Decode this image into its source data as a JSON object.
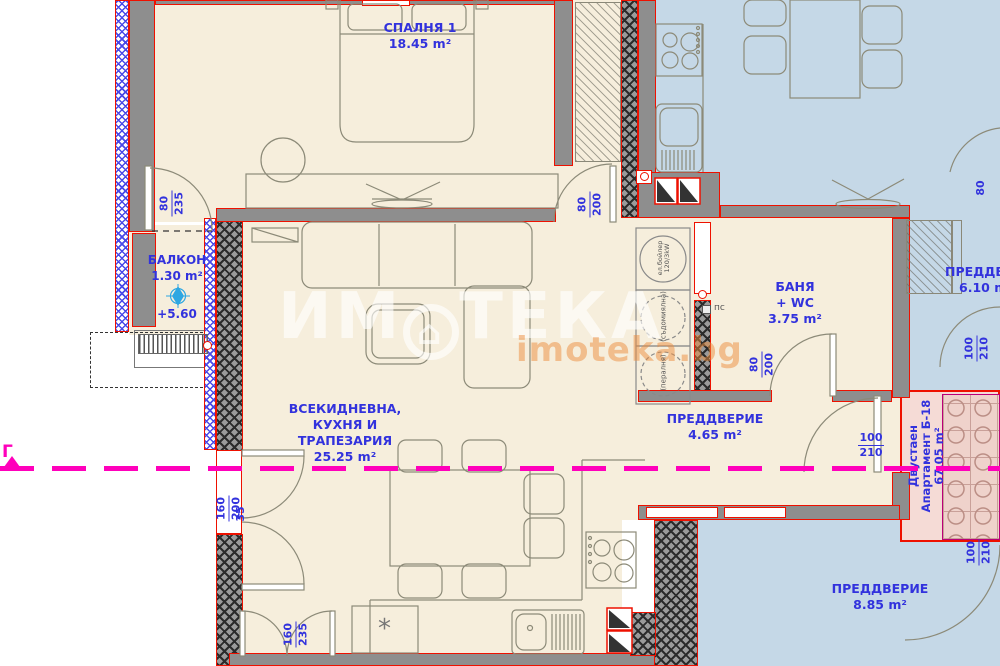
{
  "rooms": {
    "bedroom": {
      "name": "СПАЛНЯ 1",
      "area": "18.45 m²"
    },
    "balcony": {
      "name": "БАЛКОН",
      "area": "1.30 m²",
      "level": "+5.60"
    },
    "living": {
      "name_line1": "ВСЕКИДНЕВНА,",
      "name_line2": "КУХНЯ И",
      "name_line3": "ТРАПЕЗАРИЯ",
      "area": "25.25 m²"
    },
    "bathroom": {
      "name": "БАНЯ",
      "name2": "+ WC",
      "area": "3.75 m²"
    },
    "hallway": {
      "name": "ПРЕДДВЕРИЕ",
      "area": "4.65 m²"
    },
    "corridor_right": {
      "name": "ПРЕДДВЕРИЕ",
      "area": "6.10 m²"
    },
    "vestibule_bottom": {
      "name": "ПРЕДДВЕРИЕ",
      "area": "8.85 m²"
    }
  },
  "apartment": {
    "type": "Двустаен",
    "name": "Апартамент Б-18",
    "area": "67.05 m²"
  },
  "appliances": {
    "boiler_line1": "ел.бойлер",
    "boiler_line2": "120/3kW",
    "dishwasher": "(съдомиялна)",
    "washer": "(пералня)",
    "ps": "пс"
  },
  "dimensions": {
    "balcony_door": {
      "w": "80",
      "h": "235"
    },
    "bedroom_door": {
      "w": "80",
      "h": "200"
    },
    "bathroom_door": {
      "w": "80",
      "h": "200"
    },
    "living_window": {
      "w": "160",
      "h": "200",
      "offset": "35"
    },
    "kitchen_window": {
      "w": "160",
      "h": "235"
    },
    "entrance_door": {
      "w": "100",
      "h": "210"
    },
    "corridor_door_right": {
      "w": "100",
      "h": "210"
    },
    "vestibule_door": {
      "w": "100",
      "h": "210"
    },
    "top_right_door": {
      "w": "80"
    }
  },
  "section_line": {
    "label": "Г"
  },
  "symbols": {
    "kitchen_marker": "*",
    "house_glyph": "⌂"
  },
  "watermark": {
    "brand_prefix": "ИМ",
    "brand_suffix": "ТЕКА",
    "site": "imoteka.bg"
  },
  "colors": {
    "label_blue": "#3232dd",
    "wall_red": "#ee1100",
    "section_magenta": "#ff00bb",
    "apartment_fill": "#f6eedc",
    "neighbor_fill": "#c5d8e7",
    "stair_fill": "#f5dbd6"
  }
}
